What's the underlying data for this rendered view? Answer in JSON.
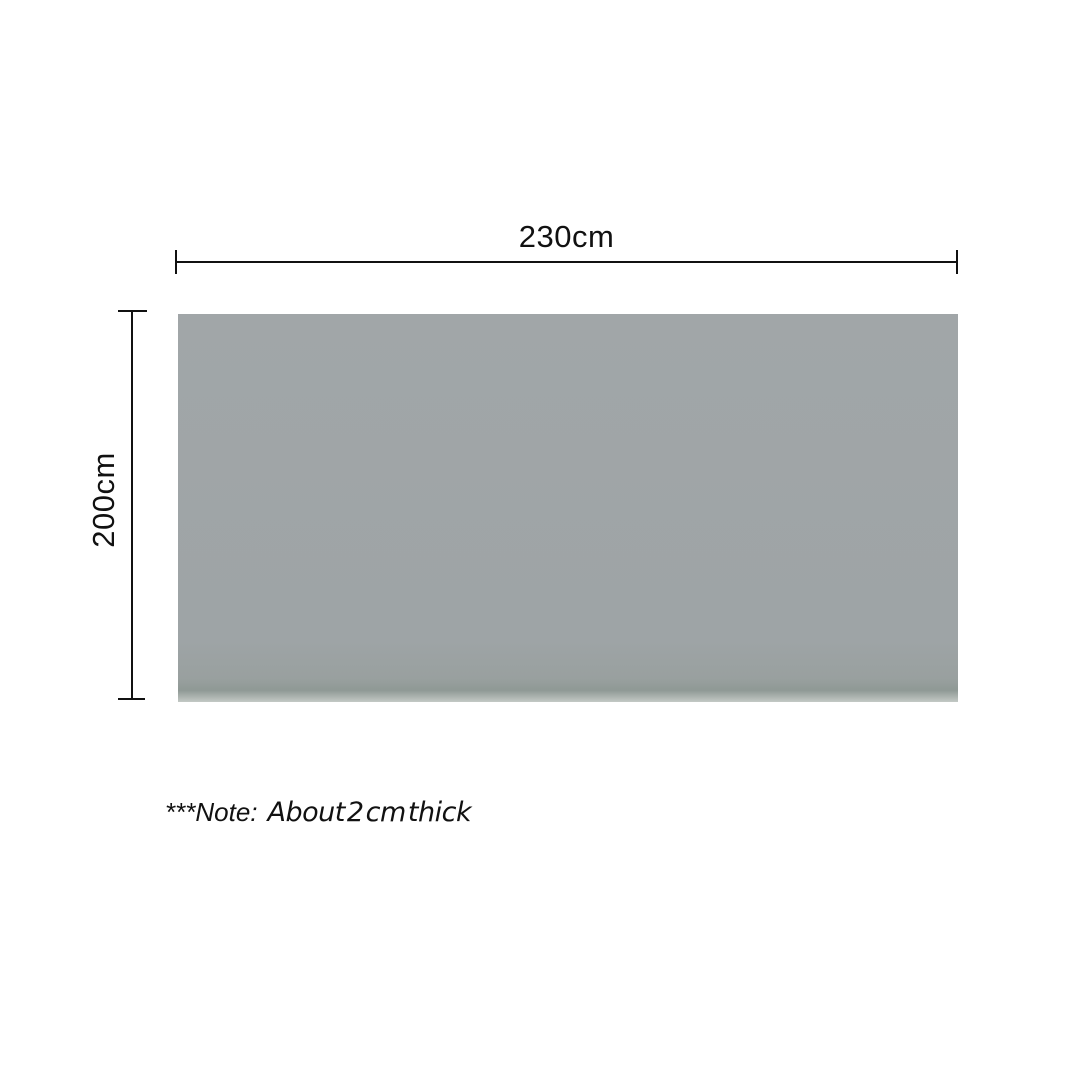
{
  "diagram": {
    "width_label": "230cm",
    "height_label": "200cm",
    "note": {
      "prefix": "***Note:",
      "text": "About 2 cm thick"
    },
    "colors": {
      "panel_gray": "#9ea4a6",
      "line_black": "#111111",
      "background": "#ffffff"
    }
  }
}
